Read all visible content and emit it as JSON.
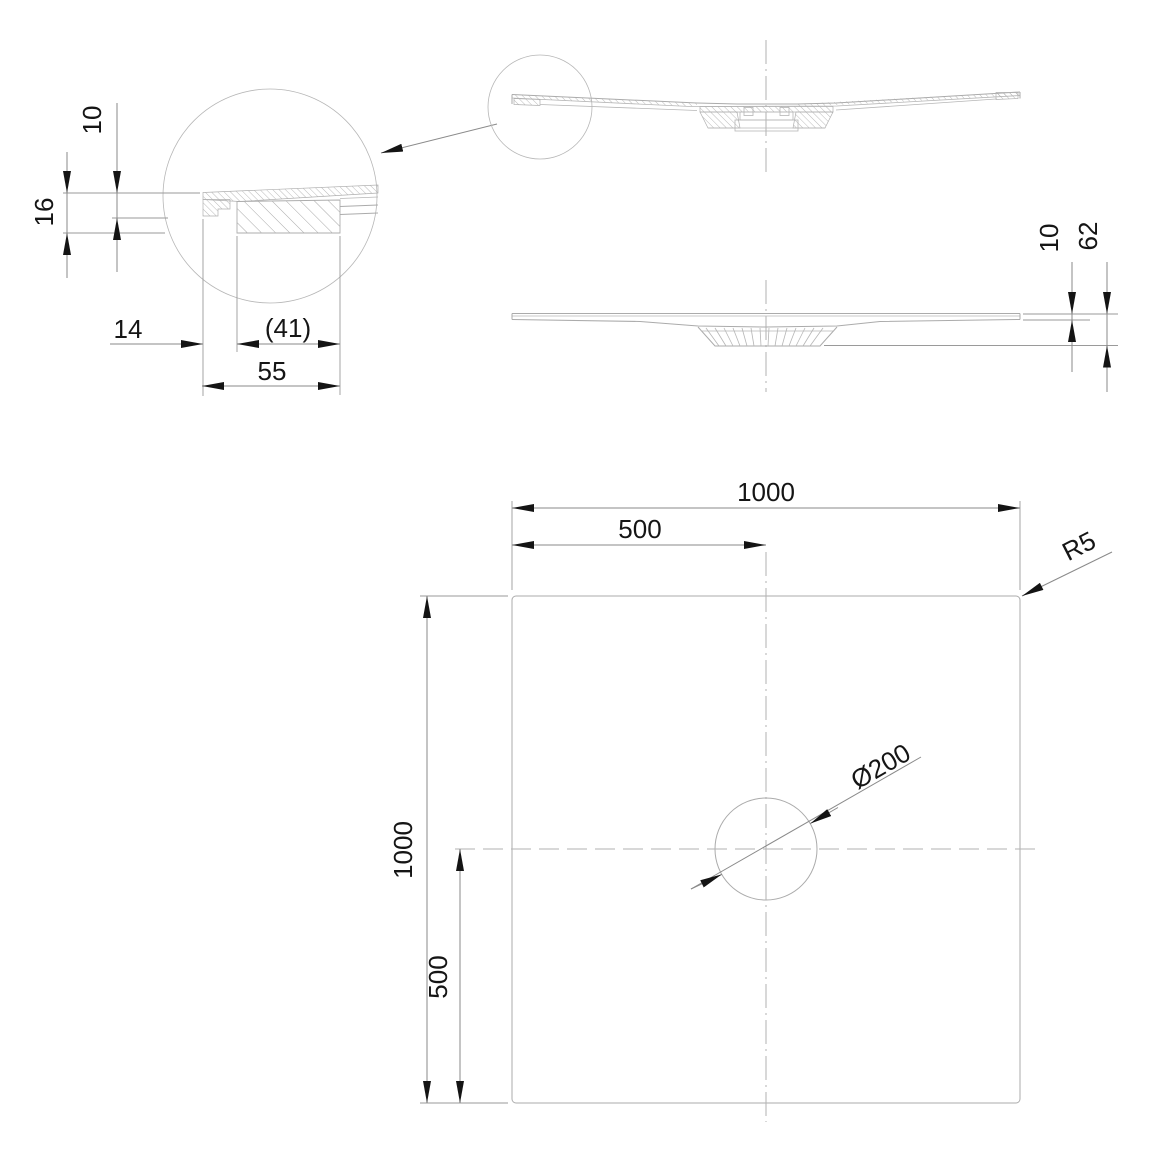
{
  "drawing": {
    "type": "shower-tray technical drawing, 3 views + detail",
    "labels": {
      "detail_plate_thickness": "10",
      "detail_total_thickness": "16",
      "detail_edge_offset": "14",
      "detail_inner_width": "(41)",
      "detail_outer_width": "55",
      "side_plate_thickness": "10",
      "side_total_height": "62",
      "plan_width": "1000",
      "plan_width_half": "500",
      "plan_depth": "1000",
      "plan_depth_half": "500",
      "plan_corner_radius": "R5",
      "plan_drain_diameter": "Ø200"
    },
    "colors": {
      "geometry_line": "#ababab",
      "dimension_line": "#8a8a8a",
      "text": "#151515",
      "background": "#ffffff"
    }
  }
}
